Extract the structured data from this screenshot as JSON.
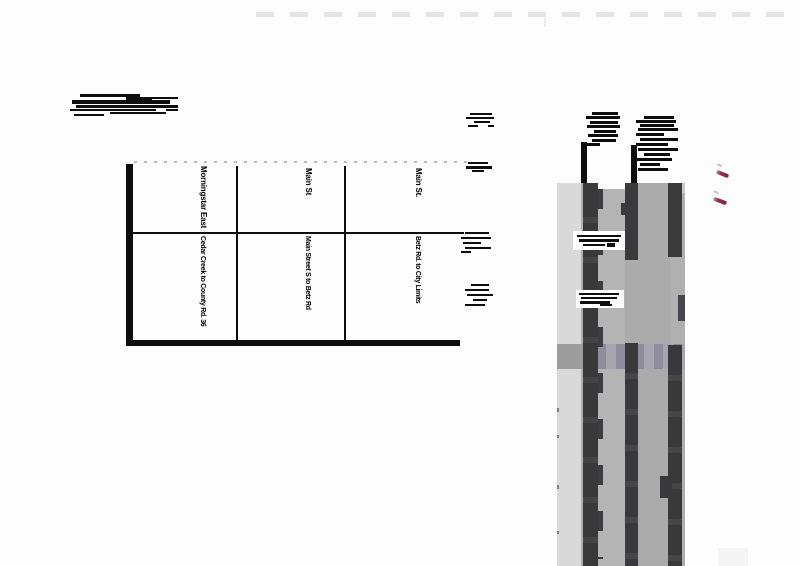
{
  "table": {
    "columns": [
      {
        "street": "Morningstar East",
        "segment": "Cedar Creek to County Rd. 36"
      },
      {
        "street": "Main St",
        "segment": "Main Street S to Betz Rd"
      },
      {
        "street": "Main St.",
        "segment": "Betz Rd. to City Limits"
      }
    ]
  },
  "colors": {
    "ink": "#0d0d0d",
    "photo_light_strip": "#d9d9d9",
    "photo_field": "#aeaeae",
    "photo_dark_stripe": "#3a3a3c",
    "road_band_stripe_a": "#8f8c9d",
    "road_band_stripe_b": "#a7a5b1",
    "checkmark_red": "#8e3050"
  }
}
